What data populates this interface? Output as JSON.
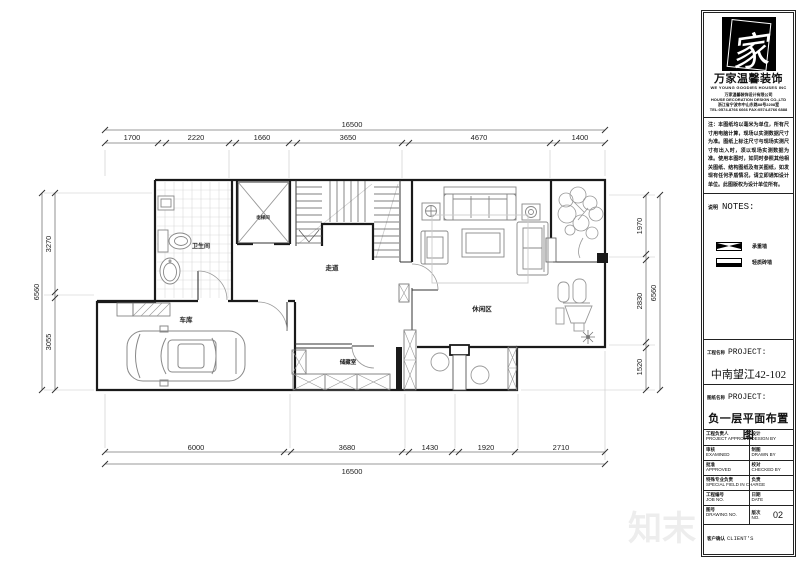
{
  "plan": {
    "rooms": {
      "bathroom": "卫生间",
      "elevator": "电梯间",
      "corridor": "走道",
      "garage": "车库",
      "storage": "储藏室",
      "leisure": "休闲区"
    },
    "dims": {
      "top_total": "16500",
      "top": [
        "1700",
        "2220",
        "1660",
        "3650",
        "4670",
        "1400"
      ],
      "bottom": [
        "6000",
        "3680",
        "1430",
        "1920",
        "2710"
      ],
      "bottom_total": "16500",
      "left": [
        "3270",
        "3055"
      ],
      "left_total": "6560",
      "right": [
        "1970",
        "2830",
        "1520"
      ],
      "right_total": "6560"
    },
    "watermark": "知末"
  },
  "panel": {
    "logo_glyph": "家",
    "company_name": "万家温馨装饰",
    "company_tagline": "WE YOUNG GOODIES HOUSES INC",
    "company_info": [
      "万家温馨装饰设计有限公司",
      "HOUSE DECORATION DESIGN CO.,LTD",
      "浙江省宁波市中山东路88号2208室",
      "TEL:0574-8766 6666  FAX:0574-8766 6888"
    ],
    "disclaimer": "注：本图纸均以毫米为单位，所有尺寸用电脑计算，现场以实测数据尺寸为准。图纸上标注尺寸与现场实测尺寸有出入时，须以现场实测数据为准。使用本图时，如同时参照其他相关图纸、结构图纸及有关图纸，如发现有任何矛盾情况，请立即通知设计单位。此图版权为设计单位所有。",
    "notes": {
      "label_zh": "说明",
      "label_en": "NOTES:",
      "legend": [
        {
          "icon": "load-bearing-wall-symbol",
          "label": "承重墙"
        },
        {
          "icon": "brick-wall-symbol",
          "label": "轻质砖墙"
        }
      ]
    },
    "project": {
      "label_zh": "工程名称",
      "label_en": "PROJECT:",
      "value": "中南望江42-102"
    },
    "drawing": {
      "label_zh": "图纸名称",
      "label_en": "PROJECT:",
      "value": "负一层平面布置图"
    },
    "table": {
      "rows": [
        [
          {
            "zh": "工程负责人",
            "en": "PROJECT APPROVER"
          },
          {
            "zh": "设计",
            "en": "DESIGN BY"
          }
        ],
        [
          {
            "zh": "审核",
            "en": "EXAMINED"
          },
          {
            "zh": "制图",
            "en": "DRAWN BY"
          }
        ],
        [
          {
            "zh": "批准",
            "en": "APPROVED"
          },
          {
            "zh": "校对",
            "en": "CHECKED BY"
          }
        ],
        [
          {
            "zh": "特殊专业负责",
            "en": "SPECIAL FIELD IN CHARGE"
          },
          {
            "zh": "负责",
            "en": ""
          }
        ],
        [
          {
            "zh": "工程编号",
            "en": "JOB NO."
          },
          {
            "zh": "日期",
            "en": "DATE"
          }
        ]
      ],
      "drawing_no": {
        "zh": "图号",
        "en": "DRAWING NO."
      },
      "version": {
        "zh": "版次",
        "en": "NO.",
        "value": "02"
      },
      "client_row": {
        "zh": "客户确认",
        "en": "CLIENT'S"
      }
    }
  }
}
